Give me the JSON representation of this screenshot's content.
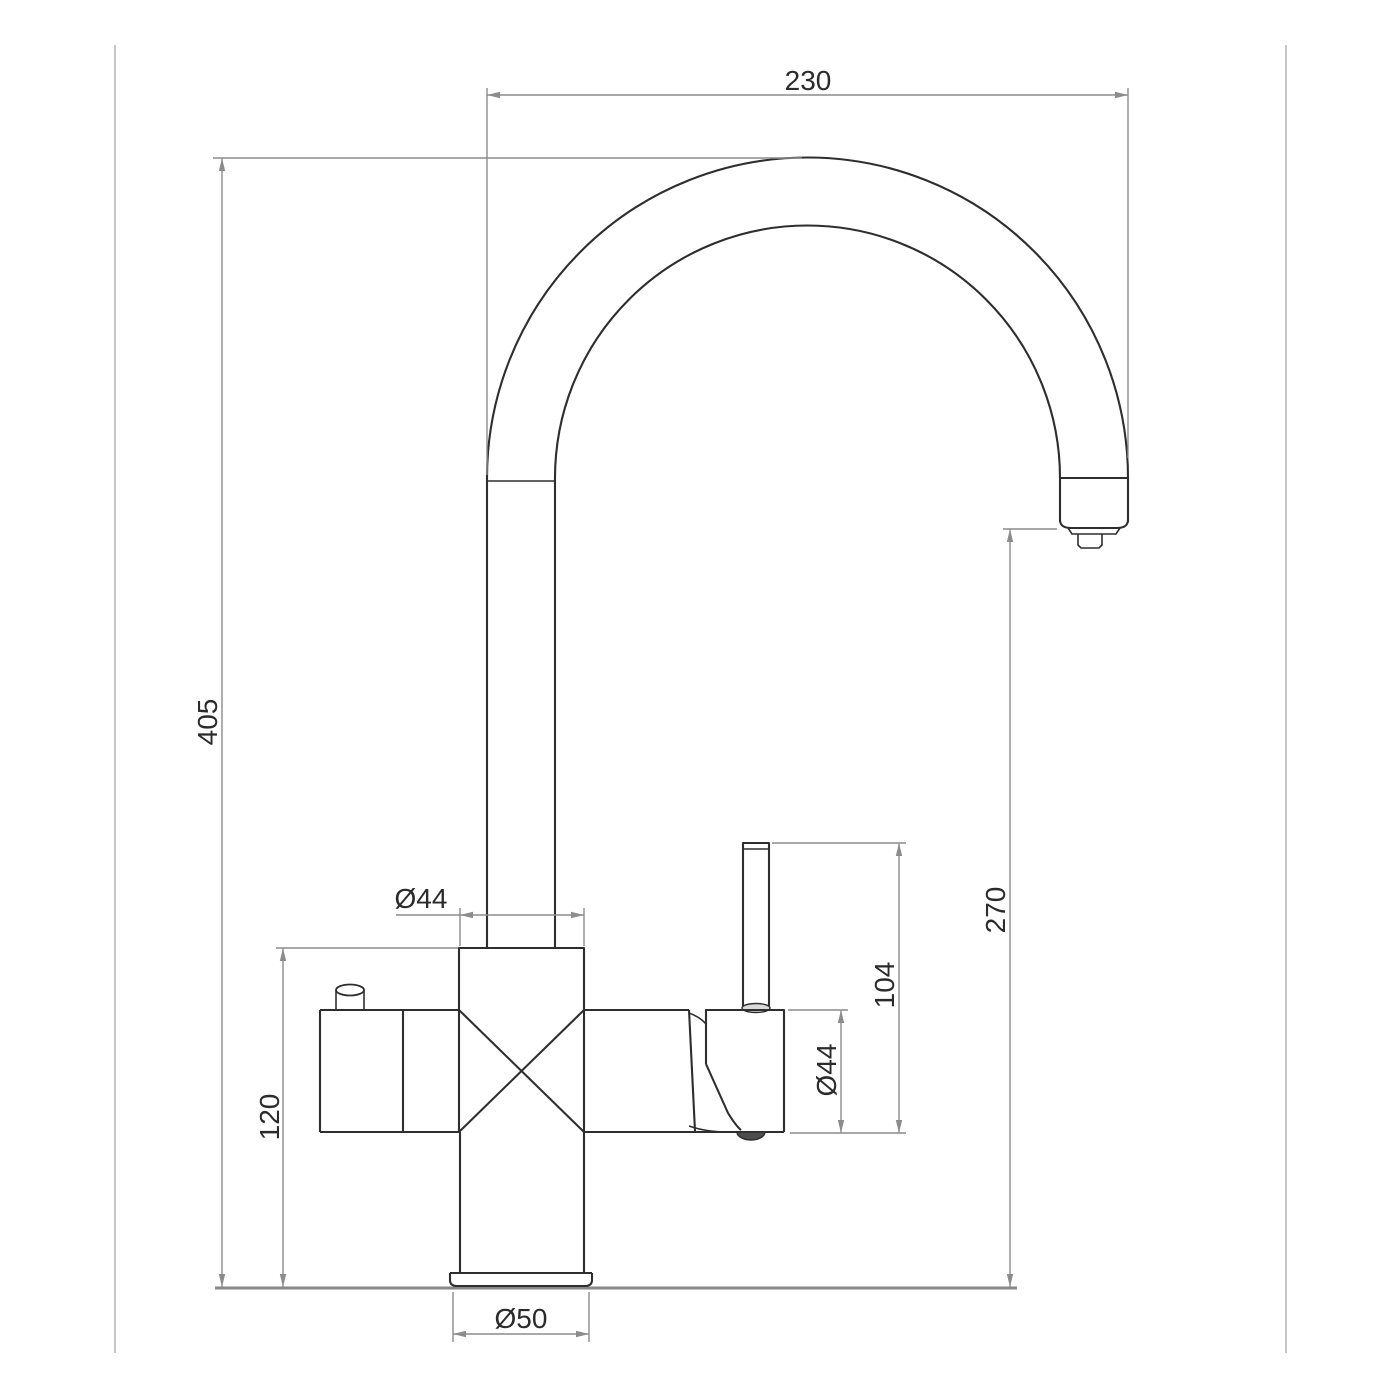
{
  "drawing_type": "kitchen-mixer-tap-technical-drawing",
  "dimensions": {
    "spout_reach": "230",
    "overall_height": "405",
    "body_height": "120",
    "spout_outlet_height": "270",
    "handle_lever_height": "104",
    "column_diameter": "Ø44",
    "handle_body_diameter": "Ø44",
    "base_diameter": "Ø50"
  },
  "colors": {
    "outline": "#2e2e2e",
    "dimension_line": "#8c8c8c",
    "label_text": "#2b2b2b",
    "frame_line": "#b3b3b3",
    "counter_line": "#878787",
    "background": "#ffffff",
    "handle_end_fill": "#4d4d4d",
    "lever_base_fill": "#d9d9d9"
  }
}
